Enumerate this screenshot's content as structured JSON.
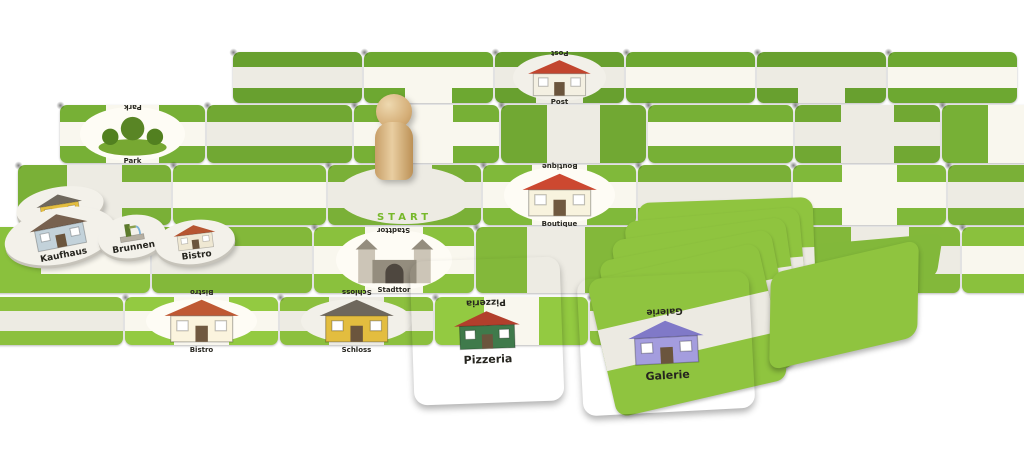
{
  "board": {
    "start_label": "START",
    "start_color": "#76b82a",
    "path_color": "#edebe3",
    "row_colors": [
      "#68a02f",
      "#71a833",
      "#7ab037",
      "#83b83a",
      "#8cc03e"
    ],
    "rows": [
      {
        "left": 233,
        "top": 52,
        "w": 131,
        "h": 53,
        "tiles": [
          {
            "s": "EW"
          },
          {
            "s": "EWS"
          },
          {
            "s": "EWS",
            "loc": "post"
          },
          {
            "s": "EW"
          },
          {
            "s": "EWS"
          },
          {
            "s": "EW"
          }
        ]
      },
      {
        "left": 60,
        "top": 105,
        "w": 147,
        "h": 60,
        "tiles": [
          {
            "s": "NSEW",
            "loc": "park"
          },
          {
            "s": "EW"
          },
          {
            "s": "NSEW"
          },
          {
            "s": "NS"
          },
          {
            "s": "EW"
          },
          {
            "s": "NSEW"
          },
          {
            "s": "NS"
          }
        ]
      },
      {
        "left": 18,
        "top": 165,
        "w": 155,
        "h": 62,
        "tiles": [
          {
            "s": "NSE"
          },
          {
            "s": "EW"
          },
          {
            "s": "NEW",
            "start": true
          },
          {
            "s": "NSEW",
            "loc": "boutique"
          },
          {
            "s": "EW"
          },
          {
            "s": "NSEW"
          },
          {
            "s": "EW"
          }
        ]
      },
      {
        "left": -10,
        "top": 227,
        "w": 162,
        "h": 68,
        "tiles": [
          {
            "s": "NE"
          },
          {
            "s": "EW"
          },
          {
            "s": "NSEW",
            "loc": "stadttor"
          },
          {
            "s": "NS"
          },
          {
            "s": "EW"
          },
          {
            "s": "NSEW"
          },
          {
            "s": "EW"
          }
        ]
      },
      {
        "left": -30,
        "top": 297,
        "w": 155,
        "h": 50,
        "tiles": [
          {
            "s": "EW"
          },
          {
            "s": "NSEW",
            "loc": "bistro"
          },
          {
            "s": "NSEW",
            "loc": "schloss"
          },
          {
            "s": "NS"
          },
          {
            "s": "EW"
          }
        ]
      }
    ]
  },
  "locations": {
    "post": {
      "label": "Post",
      "type": "house",
      "wall": "#f4f0e2",
      "roof": "#c2452e"
    },
    "park": {
      "label": "Park",
      "type": "park",
      "wall": "#557f23",
      "roof": "#4e7a1e"
    },
    "boutique": {
      "label": "Boutique",
      "type": "house",
      "wall": "#ece7d3",
      "roof": "#c2452e"
    },
    "stadttor": {
      "label": "Stadttor",
      "type": "gate",
      "wall": "#c2bcae",
      "roof": "#8d8678"
    },
    "schloss": {
      "label": "Schloss",
      "type": "house",
      "wall": "#e3bd3f",
      "roof": "#6e675c"
    },
    "bistro": {
      "label": "Bistro",
      "type": "house",
      "wall": "#efe8d3",
      "roof": "#b65531"
    },
    "pizzeria": {
      "label": "Pizzeria",
      "type": "house",
      "wall": "#3f7a4b",
      "roof": "#b23f2c"
    },
    "galerie": {
      "label": "Galerie",
      "type": "house",
      "wall": "#a49dde",
      "roof": "#8079c8"
    },
    "kaufhaus": {
      "label": "Kaufhaus",
      "type": "house",
      "wall": "#c3d2da",
      "roof": "#77614f"
    },
    "brunnen": {
      "label": "Brunnen",
      "type": "fountain",
      "wall": "#5c7a2c",
      "roof": "#8aa04e"
    }
  },
  "colors": {
    "card_green": "#9cc83e",
    "tile_green_light": "#8fc43f",
    "path_white": "#efede5",
    "pawn_wood": "#d9b98a"
  }
}
